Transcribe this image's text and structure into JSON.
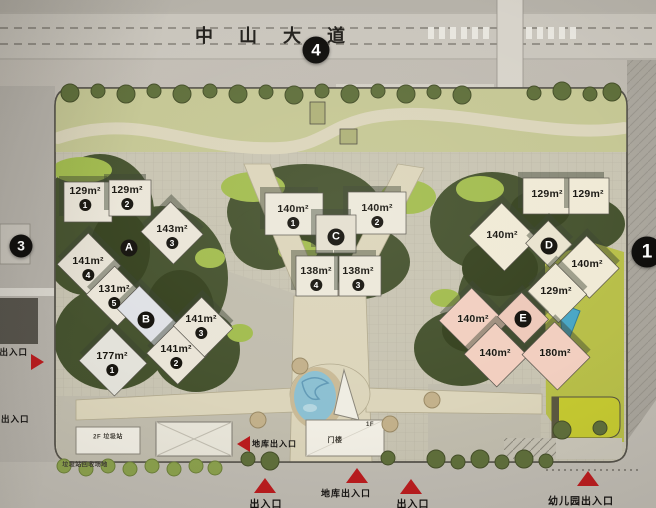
{
  "title_road": {
    "name": "中山大道"
  },
  "edge_markers": [
    {
      "label": "4",
      "x": 316,
      "y": 50,
      "d": 27
    },
    {
      "label": "3",
      "x": 21,
      "y": 246,
      "d": 23
    },
    {
      "label": "1",
      "x": 647,
      "y": 252,
      "d": 31
    }
  ],
  "block_badges": [
    {
      "letter": "A",
      "x": 129,
      "y": 248
    },
    {
      "letter": "B",
      "x": 146,
      "y": 320
    },
    {
      "letter": "C",
      "x": 336,
      "y": 237
    },
    {
      "letter": "D",
      "x": 549,
      "y": 246
    },
    {
      "letter": "E",
      "x": 523,
      "y": 319
    }
  ],
  "units": [
    {
      "area": "129m²",
      "num": "1",
      "x": 85,
      "y": 193
    },
    {
      "area": "129m²",
      "num": "2",
      "x": 127,
      "y": 192
    },
    {
      "area": "143m²",
      "num": "3",
      "x": 172,
      "y": 231
    },
    {
      "area": "141m²",
      "num": "4",
      "x": 88,
      "y": 263
    },
    {
      "area": "131m²",
      "num": "5",
      "x": 114,
      "y": 291
    },
    {
      "area": "177m²",
      "num": "1",
      "x": 112,
      "y": 358
    },
    {
      "area": "141m²",
      "num": "2",
      "x": 176,
      "y": 351
    },
    {
      "area": "141m²",
      "num": "3",
      "x": 201,
      "y": 321
    },
    {
      "area": "140m²",
      "num": "1",
      "x": 293,
      "y": 211
    },
    {
      "area": "140m²",
      "num": "2",
      "x": 377,
      "y": 210
    },
    {
      "area": "138m²",
      "num": "4",
      "x": 316,
      "y": 273
    },
    {
      "area": "138m²",
      "num": "3",
      "x": 358,
      "y": 273
    },
    {
      "area": "129m²",
      "x": 547,
      "y": 196
    },
    {
      "area": "129m²",
      "x": 588,
      "y": 196
    },
    {
      "area": "140m²",
      "x": 502,
      "y": 237
    },
    {
      "area": "140m²",
      "x": 587,
      "y": 266
    },
    {
      "area": "129m²",
      "x": 556,
      "y": 293
    },
    {
      "area": "140m²",
      "x": 473,
      "y": 321
    },
    {
      "area": "140m²",
      "x": 495,
      "y": 355
    },
    {
      "area": "180m²",
      "x": 555,
      "y": 355
    }
  ],
  "entrances": [
    {
      "label": "库出入口",
      "lx": -10,
      "ly": 352,
      "anchor": "left",
      "fs": 8.5,
      "tri": {
        "dir": "right",
        "x": 37,
        "y": 362
      }
    },
    {
      "label": "出入口",
      "lx": 1,
      "ly": 419,
      "anchor": "left",
      "fs": 8.5,
      "tri": null
    },
    {
      "label": "地库出入口",
      "lx": 252,
      "ly": 444,
      "anchor": "left",
      "fs": 8,
      "tri": {
        "dir": "left",
        "x": 243,
        "y": 444
      }
    },
    {
      "label": "出入口",
      "lx": 266,
      "ly": 503,
      "anchor": "center",
      "fs": 10,
      "tri": {
        "dir": "up",
        "x": 265,
        "y": 485
      }
    },
    {
      "label": "地库出入口",
      "lx": 346,
      "ly": 493,
      "anchor": "center",
      "fs": 9,
      "tri": {
        "dir": "up",
        "x": 357,
        "y": 475
      }
    },
    {
      "label": "出入口",
      "lx": 413,
      "ly": 503,
      "anchor": "center",
      "fs": 10,
      "tri": {
        "dir": "up",
        "x": 411,
        "y": 486
      }
    },
    {
      "label": "幼儿园出入口",
      "lx": 581,
      "ly": 500,
      "anchor": "center",
      "fs": 10,
      "tri": {
        "dir": "up",
        "x": 588,
        "y": 478
      }
    }
  ],
  "facilities": [
    {
      "label": "2F 垃圾站",
      "x": 108,
      "y": 436,
      "fs": 6
    },
    {
      "label": "垃圾站回收场地",
      "x": 85,
      "y": 464,
      "fs": 6
    },
    {
      "label": "门楼",
      "x": 335,
      "y": 440,
      "fs": 7
    },
    {
      "label": "1F",
      "x": 370,
      "y": 425,
      "fs": 6
    }
  ]
}
